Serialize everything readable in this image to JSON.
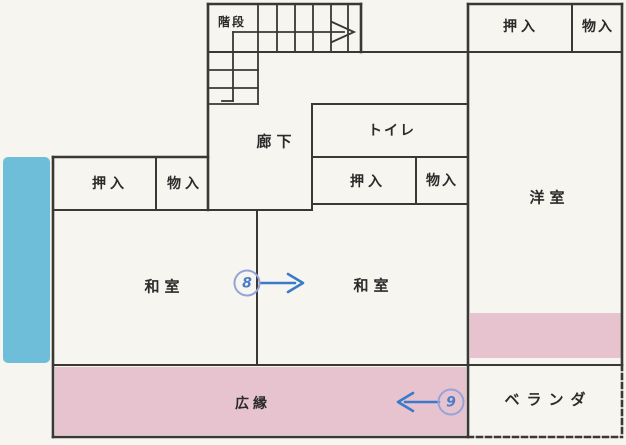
{
  "rooms": {
    "stairs": "階段",
    "hallway": "廊下",
    "toilet": "トイレ",
    "western_room": "洋室",
    "japanese_room_left": "和室",
    "japanese_room_right": "和室",
    "sun_porch": "広縁",
    "veranda": "ベランダ",
    "closet_left": "押入",
    "storage_left": "物入",
    "closet_center": "押入",
    "storage_center": "物入",
    "closet_top_right": "押入",
    "storage_top_right": "物入"
  },
  "markers": {
    "marker_8": "8",
    "marker_9": "9"
  },
  "colors": {
    "paper": "#f6f5ef",
    "ink": "#2b2b2b",
    "wall": "#3a3835",
    "pink": "#e7c3cf",
    "highlight": "#6fbed9",
    "arrow": "#3b7ac9",
    "ring": "#95a3d8",
    "digit": "#4a7cc8"
  }
}
